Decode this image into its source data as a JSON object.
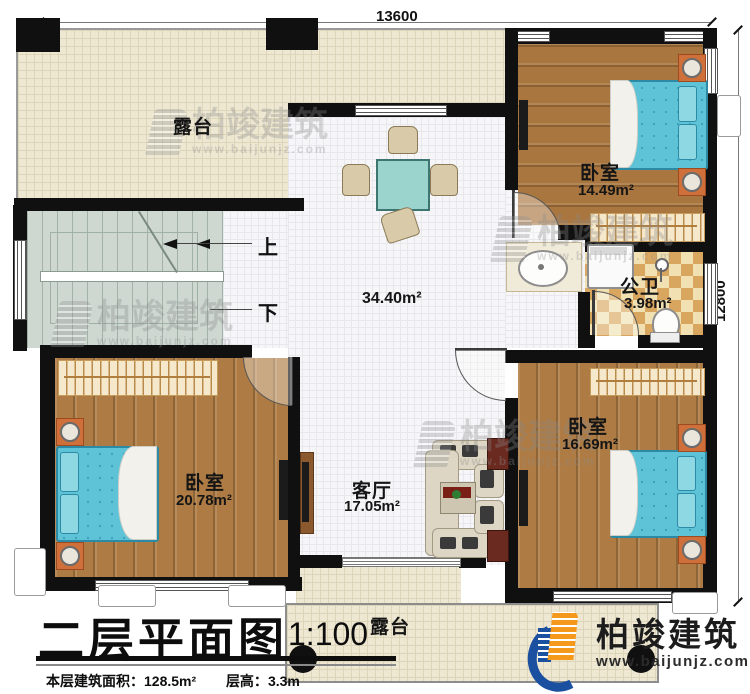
{
  "plan": {
    "dim_top": "13600",
    "dim_right": "12800",
    "rooms": {
      "terrace_top": {
        "label": "露台"
      },
      "terrace_bottom": {
        "label": "露台"
      },
      "bedroom_tr": {
        "label": "卧室",
        "area": "14.49m²"
      },
      "bedroom_bl": {
        "label": "卧室",
        "area": "20.78m²"
      },
      "bedroom_br": {
        "label": "卧室",
        "area": "16.69m²"
      },
      "living": {
        "label": "客厅",
        "area": "17.05m²"
      },
      "bathroom": {
        "label": "公卫",
        "area": "3.98m²"
      },
      "hall": {
        "area": "34.40m²"
      }
    },
    "stairs": {
      "up": "上",
      "down": "下"
    }
  },
  "title_block": {
    "title": "二层平面图",
    "scale": "1:100",
    "info_area_label": "本层建筑面积：",
    "info_area_value": "128.5m²",
    "info_height_label": "层高：",
    "info_height_value": "3.3m"
  },
  "watermark": {
    "name": "柏竣建筑",
    "url": "www.baijunjz.com"
  },
  "logo": {
    "name": "柏竣建筑",
    "url": "www.baijunjz.com"
  },
  "colors": {
    "wall": "#101010",
    "wood_floor": "#ad7b43",
    "terrace_floor": "#eee8d3",
    "tile_floor": "#f6f6f8",
    "bed_teal": "#5fc3d7",
    "logo_blue": "#1b4fa0",
    "logo_orange": "#f5991d"
  }
}
